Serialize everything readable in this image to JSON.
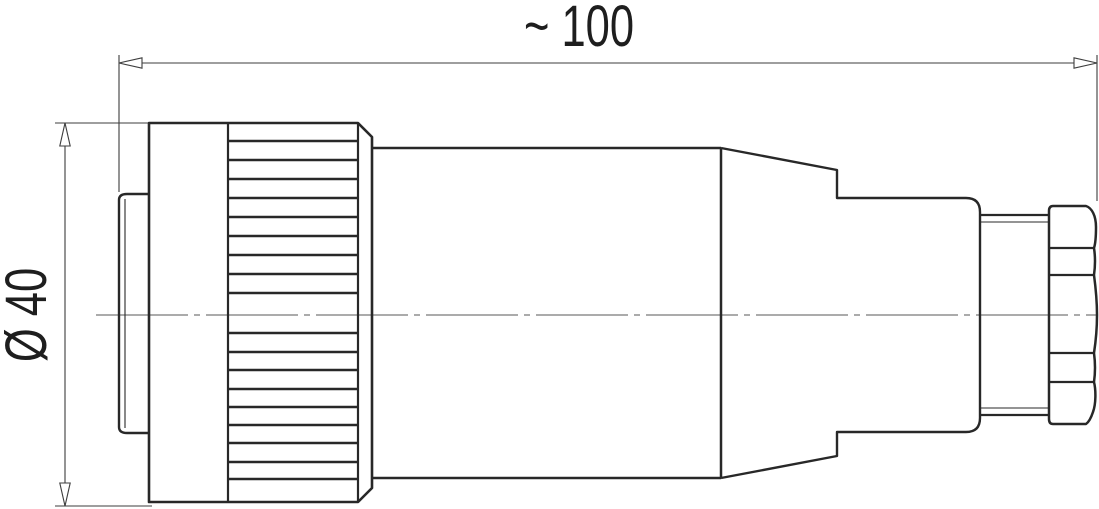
{
  "page": {
    "background": "#ffffff"
  },
  "drawing": {
    "subject": "circular-cable-connector-side-view",
    "dimension_labels": {
      "length": "~ 100",
      "diameter": "Ø 40"
    },
    "colors": {
      "outline": "#282828",
      "dimension_line": "#3d3d3d",
      "centerline": "#8f8f8f",
      "text": "#1e1e1e",
      "background": "#ffffff"
    }
  }
}
